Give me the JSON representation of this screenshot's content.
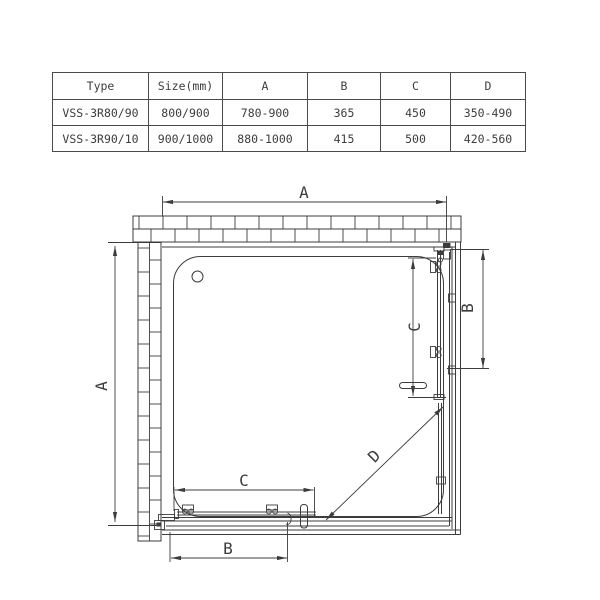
{
  "table": {
    "headers": [
      "Type",
      "Size(mm)",
      "A",
      "B",
      "C",
      "D"
    ],
    "rows": [
      [
        "VSS-3R80/90",
        "800/900",
        "780-900",
        "365",
        "450",
        "350-490"
      ],
      [
        "VSS-3R90/10",
        "900/1000",
        "880-1000",
        "415",
        "500",
        "420-560"
      ]
    ]
  },
  "diagram": {
    "labels": {
      "width_top": "A",
      "depth_left": "A",
      "door_b_right": "B",
      "clear_c_right": "C",
      "clear_c_bottom": "C",
      "door_b_bottom": "B",
      "diagonal_entry": "D"
    },
    "ink_color": "#3c3c3c",
    "background_color": "#ffffff"
  }
}
